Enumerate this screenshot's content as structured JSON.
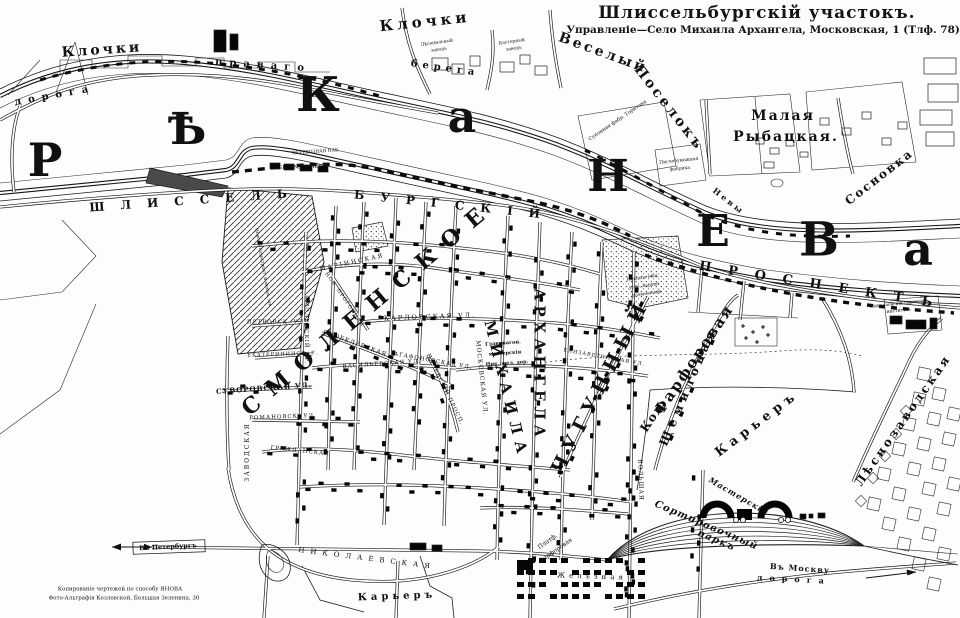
{
  "colors": {
    "ink": "#141414",
    "paper": "#fdfdfb"
  },
  "header": {
    "title": "Шлиссельбургскій участокъ.",
    "subtitle": "Управленіе—Село Михаила Архангела, Московская, 1 (Тлф. 78)."
  },
  "river_letters": [
    {
      "name": "river-letter",
      "text": "Р",
      "x": 45,
      "y": 160,
      "s": 46
    },
    {
      "name": "river-letter",
      "text": "Ѣ",
      "x": 187,
      "y": 130,
      "s": 44
    },
    {
      "name": "river-letter",
      "text": "К",
      "x": 318,
      "y": 95,
      "s": 48
    },
    {
      "name": "river-letter",
      "text": "а",
      "x": 462,
      "y": 118,
      "s": 44
    },
    {
      "name": "river-letter",
      "text": "Н",
      "x": 608,
      "y": 177,
      "s": 44
    },
    {
      "name": "river-letter",
      "text": "Е",
      "x": 713,
      "y": 232,
      "s": 44
    },
    {
      "name": "river-letter",
      "text": "В",
      "x": 819,
      "y": 240,
      "s": 47
    },
    {
      "name": "river-letter",
      "text": "а",
      "x": 918,
      "y": 249,
      "s": 46
    }
  ],
  "labels": [
    {
      "name": "label-klochki-west",
      "text": "Клочки",
      "x": 102,
      "y": 50,
      "r": -4,
      "s": 14,
      "sp": 3,
      "b": 1
    },
    {
      "name": "label-klochki-east",
      "text": "Клочки",
      "x": 425,
      "y": 22,
      "r": -6,
      "s": 15,
      "sp": 4,
      "b": 1
    },
    {
      "name": "label-veselyi",
      "text": "Веселый",
      "x": 603,
      "y": 53,
      "r": 20,
      "s": 14,
      "sp": 3,
      "b": 1
    },
    {
      "name": "label-poselok",
      "text": "Поселокъ",
      "x": 669,
      "y": 108,
      "r": 52,
      "s": 14,
      "sp": 3,
      "b": 1
    },
    {
      "name": "label-malaya",
      "text": "Малая",
      "x": 783,
      "y": 116,
      "r": 0,
      "s": 14,
      "sp": 2,
      "b": 1
    },
    {
      "name": "label-rybatskaya",
      "text": "Рыбацкая.",
      "x": 786,
      "y": 137,
      "r": 0,
      "s": 14,
      "sp": 2,
      "b": 1
    },
    {
      "name": "label-sosnovka",
      "text": "Сосновка",
      "x": 879,
      "y": 177,
      "r": -38,
      "s": 12,
      "sp": 2,
      "b": 1
    },
    {
      "name": "label-doroga-bank",
      "text": "дорога",
      "x": 55,
      "y": 96,
      "r": -10,
      "s": 10,
      "sp": 7,
      "b": 1
    },
    {
      "name": "label-pravago",
      "text": "праваго",
      "x": 263,
      "y": 66,
      "r": 4,
      "s": 10,
      "sp": 7,
      "b": 1
    },
    {
      "name": "label-berega",
      "text": "берега",
      "x": 445,
      "y": 69,
      "r": 8,
      "s": 10,
      "sp": 5,
      "b": 1
    },
    {
      "name": "label-nevy",
      "text": "Невы",
      "x": 729,
      "y": 201,
      "r": 38,
      "s": 8,
      "sp": 3,
      "b": 1
    },
    {
      "name": "label-shlissel",
      "text": "ШЛИССЕЛЬ",
      "x": 196,
      "y": 200,
      "r": -4,
      "s": 12,
      "sp": 16,
      "b": 1
    },
    {
      "name": "label-burgskiy",
      "text": "БУРГСКІЙ",
      "x": 455,
      "y": 205,
      "r": 6,
      "s": 12,
      "sp": 16,
      "b": 1
    },
    {
      "name": "label-prospekt",
      "text": "ПРОСПЕКТЪ",
      "x": 824,
      "y": 286,
      "r": 9,
      "s": 13,
      "sp": 17,
      "b": 1
    },
    {
      "name": "label-smolenskoe",
      "text": "СМОЛЕНСКОЕ",
      "x": 368,
      "y": 308,
      "r": -40,
      "s": 22,
      "sp": 13,
      "b": 1
    },
    {
      "name": "label-mikhaila",
      "text": "МИХАИЛА",
      "x": 506,
      "y": 390,
      "r": 76,
      "s": 15,
      "sp": 7,
      "b": 1
    },
    {
      "name": "label-arkhangela",
      "text": "АРХАНГЕЛА",
      "x": 539,
      "y": 365,
      "r": 90,
      "s": 15,
      "sp": 5,
      "b": 1
    },
    {
      "name": "label-chugunnyi",
      "text": "ЧУГУННЫЙ",
      "x": 601,
      "y": 386,
      "r": -63,
      "s": 19,
      "sp": 7,
      "b": 1
    },
    {
      "name": "label-shchemilovaya",
      "text": "Щемиловая",
      "x": 688,
      "y": 386,
      "r": -67,
      "s": 12,
      "sp": 5,
      "b": 1
    },
    {
      "name": "label-kol",
      "text": "Кол.",
      "x": 653,
      "y": 416,
      "r": -56,
      "s": 12,
      "sp": 1,
      "b": 1
    },
    {
      "name": "label-farforovaya",
      "text": "Фарфоровая",
      "x": 694,
      "y": 360,
      "r": -56,
      "s": 15,
      "sp": 2,
      "b": 1
    },
    {
      "name": "label-karier-east",
      "text": "Карьеръ",
      "x": 757,
      "y": 424,
      "r": -37,
      "s": 13,
      "sp": 5,
      "b": 1
    },
    {
      "name": "label-karier-south",
      "text": "Карьеръ",
      "x": 397,
      "y": 597,
      "r": -2,
      "s": 10,
      "sp": 4,
      "b": 1
    },
    {
      "name": "label-lesnozavodskaya",
      "text": "Лѣснозаводская",
      "x": 903,
      "y": 420,
      "r": -55,
      "s": 12,
      "sp": 3,
      "b": 1
    },
    {
      "name": "label-nikolaevskaya-rw",
      "text": "НИКОЛАЕВСКАЯ",
      "x": 367,
      "y": 559,
      "r": 7,
      "s": 7,
      "sp": 6,
      "b": 0
    },
    {
      "name": "label-platf",
      "text": "Платф.",
      "x": 548,
      "y": 542,
      "r": -35,
      "s": 6,
      "sp": 0,
      "b": 0
    },
    {
      "name": "label-platf-farforovaya",
      "text": "Фарфоровая",
      "x": 556,
      "y": 551,
      "r": -35,
      "s": 6,
      "sp": 0,
      "b": 0
    },
    {
      "name": "label-zheleznaya",
      "text": "Желѣзная",
      "x": 592,
      "y": 577,
      "r": 2,
      "s": 7,
      "sp": 4,
      "b": 0
    },
    {
      "name": "label-masterskiya",
      "text": "Мастерскія",
      "x": 739,
      "y": 496,
      "r": 30,
      "s": 8,
      "sp": 1,
      "b": 1,
      "i": 1
    },
    {
      "name": "label-sortirovochnyi",
      "text": "Сортировочный",
      "x": 706,
      "y": 526,
      "r": 23,
      "s": 10,
      "sp": 1,
      "b": 1,
      "i": 1
    },
    {
      "name": "label-park",
      "text": "паркъ",
      "x": 716,
      "y": 541,
      "r": 23,
      "s": 10,
      "sp": 1,
      "b": 1,
      "i": 1
    },
    {
      "name": "label-v-peterburg",
      "text": "Въ Петербургъ",
      "x": 168,
      "y": 547,
      "r": -3,
      "s": 6.5,
      "sp": 0,
      "b": 1
    },
    {
      "name": "label-v-moskvu",
      "text": "Въ Москву",
      "x": 800,
      "y": 568,
      "r": 4,
      "s": 8,
      "sp": 1,
      "b": 1
    },
    {
      "name": "label-doroga-south",
      "text": "дорога",
      "x": 794,
      "y": 579,
      "r": 3,
      "s": 8,
      "sp": 7,
      "b": 1
    },
    {
      "name": "label-marinskaya",
      "text": "МАРІИНСКАЯ",
      "x": 352,
      "y": 263,
      "r": -12,
      "s": 6,
      "sp": 2,
      "b": 0
    },
    {
      "name": "label-nov-progonnaya",
      "text": "НОВ. ПРОГОННАЯ",
      "x": 344,
      "y": 300,
      "r": 55,
      "s": 5,
      "sp": 1,
      "b": 0
    },
    {
      "name": "label-petrovskaya",
      "text": "ПЕТРОВСК. УЛ.",
      "x": 277,
      "y": 323,
      "r": 0,
      "s": 5.5,
      "sp": 1,
      "b": 0
    },
    {
      "name": "label-ekaterininskaya",
      "text": "ЕКАТЕРИНИНСК. У.",
      "x": 283,
      "y": 355,
      "r": -2,
      "s": 5,
      "sp": 1,
      "b": 0
    },
    {
      "name": "label-suvorovskaya",
      "text": "СУВОРОВСКАЯ УЛ.",
      "x": 264,
      "y": 388,
      "r": -4,
      "s": 7,
      "sp": 1,
      "b": 1
    },
    {
      "name": "label-vasilievskaya",
      "text": "ВАСИЛЬЕВСКАЯ УЛ.",
      "x": 382,
      "y": 365,
      "r": -4,
      "s": 5.5,
      "sp": 1,
      "b": 0
    },
    {
      "name": "label-romanovskaya",
      "text": "РОМАНОВСК. УЛ.",
      "x": 283,
      "y": 418,
      "r": -2,
      "s": 5.5,
      "sp": 1,
      "b": 0
    },
    {
      "name": "label-zavodskaya",
      "text": "ЗАВОДСКАЯ",
      "x": 248,
      "y": 452,
      "r": -90,
      "s": 6,
      "sp": 2,
      "b": 0
    },
    {
      "name": "label-smolenskiy-pr",
      "text": "СМОЛЕНСКІЙ ПР.",
      "x": 305,
      "y": 330,
      "r": 90,
      "s": 5.5,
      "sp": 1,
      "b": 0
    },
    {
      "name": "label-palevskiy",
      "text": "ПАЛЕВСКІЙ ПРОСП.",
      "x": 444,
      "y": 390,
      "r": 64,
      "s": 5.5,
      "sp": 1,
      "b": 0
    },
    {
      "name": "label-karlovskaya",
      "text": "КАРЛОВСКАЯ УЛ.",
      "x": 430,
      "y": 317,
      "r": -2,
      "s": 6.5,
      "sp": 2,
      "b": 0
    },
    {
      "name": "label-skobelevskaya",
      "text": "СКОБЕЛЕВСКАЯ",
      "x": 355,
      "y": 344,
      "r": 20,
      "s": 6,
      "sp": 1,
      "b": 0
    },
    {
      "name": "label-agafonovskaya",
      "text": "АГАФОНОВСКАЯ УЛ.",
      "x": 433,
      "y": 362,
      "r": 10,
      "s": 5.5,
      "sp": 1,
      "b": 0
    },
    {
      "name": "label-moskovskaya",
      "text": "МОСКОВСКАЯ УЛ.",
      "x": 481,
      "y": 378,
      "r": 84,
      "s": 6,
      "sp": 1,
      "b": 0
    },
    {
      "name": "label-elizavetinskaya",
      "text": "ЕЛИЗАВЕТИНСКАЯ УЛ.",
      "x": 604,
      "y": 358,
      "r": 10,
      "s": 5,
      "sp": 1,
      "b": 0
    },
    {
      "name": "label-grazhdanskaya",
      "text": "ГРАЖДАНСКАЯ",
      "x": 300,
      "y": 452,
      "r": 6,
      "s": 5.5,
      "sp": 1,
      "b": 0
    },
    {
      "name": "label-bolshaya",
      "text": "БОЛЬШАЯ",
      "x": 640,
      "y": 480,
      "r": 88,
      "s": 6,
      "sp": 1,
      "b": 0
    },
    {
      "name": "label-glav-vagon",
      "text": "Глав. вагон.",
      "x": 503,
      "y": 344,
      "r": -4,
      "s": 5,
      "sp": 0,
      "b": 1
    },
    {
      "name": "label-masterskiya-vagon",
      "text": "мастерскія",
      "x": 505,
      "y": 354,
      "r": -4,
      "s": 5,
      "sp": 0,
      "b": 1
    },
    {
      "name": "label-nik-zhel-dor",
      "text": "Ник. жел. дор.",
      "x": 507,
      "y": 364,
      "r": -4,
      "s": 5,
      "sp": 0,
      "b": 1
    },
    {
      "name": "label-lesopilnyi",
      "text": "Лѣсопильный",
      "x": 437,
      "y": 44,
      "r": -8,
      "s": 4.5,
      "sp": 0,
      "b": 0
    },
    {
      "name": "label-lesopilnyi-zavod",
      "text": "заводъ",
      "x": 439,
      "y": 51,
      "r": -8,
      "s": 4.5,
      "sp": 0,
      "b": 0
    },
    {
      "name": "label-kastornyi",
      "text": "Касторный",
      "x": 512,
      "y": 43,
      "r": -8,
      "s": 4.5,
      "sp": 0,
      "b": 0
    },
    {
      "name": "label-kastornyi-zavod",
      "text": "заводъ",
      "x": 514,
      "y": 50,
      "r": -8,
      "s": 4.5,
      "sp": 0,
      "b": 0
    },
    {
      "name": "label-tornton",
      "text": "Суконная фабр. Торнтона",
      "x": 618,
      "y": 121,
      "r": -34,
      "s": 5,
      "sp": 0,
      "b": 0
    },
    {
      "name": "label-pischebumazhnaya",
      "text": "Писчебумажная",
      "x": 679,
      "y": 162,
      "r": -6,
      "s": 4.5,
      "sp": 0,
      "b": 0
    },
    {
      "name": "label-fabrika",
      "text": "фабрика",
      "x": 680,
      "y": 170,
      "r": -6,
      "s": 4.5,
      "sp": 0,
      "b": 0
    },
    {
      "name": "label-perevoznaya",
      "text": "ПЕРЕВОЗНАЯ НАБ.",
      "x": 316,
      "y": 153,
      "r": -4,
      "s": 4.5,
      "sp": 0,
      "b": 0
    },
    {
      "name": "label-bezymen-per",
      "text": "БЕЗЫМЕН. ПЕР.",
      "x": 301,
      "y": 168,
      "r": -2,
      "s": 5,
      "sp": 0,
      "b": 0
    },
    {
      "name": "label-nevskoe-obshch",
      "text": "Невское общ.",
      "x": 643,
      "y": 279,
      "r": -8,
      "s": 4.5,
      "sp": 0,
      "b": 0
    },
    {
      "name": "label-ustr-narodn",
      "text": "устр. народн.",
      "x": 645,
      "y": 287,
      "r": -8,
      "s": 4.5,
      "sp": 0,
      "b": 0
    },
    {
      "name": "label-razvlecheniy",
      "text": "развлеченій",
      "x": 647,
      "y": 295,
      "r": -8,
      "s": 4.5,
      "sp": 0,
      "b": 0
    },
    {
      "name": "label-sirotskiy-institut",
      "text": "Николаевскій сиротскій",
      "x": 899,
      "y": 305,
      "r": -6,
      "s": 4.5,
      "sp": 0,
      "b": 0
    },
    {
      "name": "label-institut",
      "text": "институтъ",
      "x": 899,
      "y": 312,
      "r": -6,
      "s": 4.5,
      "sp": 0,
      "b": 0
    },
    {
      "name": "label-nevskiy-zavod",
      "text": "Невскій судостроит. и механ. зав.",
      "x": 262,
      "y": 268,
      "r": 80,
      "s": 4.5,
      "sp": 0,
      "b": 0
    },
    {
      "name": "credit-line-1",
      "text": "Копированіе чертежей по способу ЯНОВА",
      "x": 120,
      "y": 590,
      "r": 0,
      "s": 5.5,
      "sp": 0,
      "b": 0
    },
    {
      "name": "credit-line-2",
      "text": "Фото-Альграфія Козловской, Большая Зеленина, 30",
      "x": 124,
      "y": 599,
      "r": 0,
      "s": 5.5,
      "sp": 0,
      "b": 0
    }
  ]
}
